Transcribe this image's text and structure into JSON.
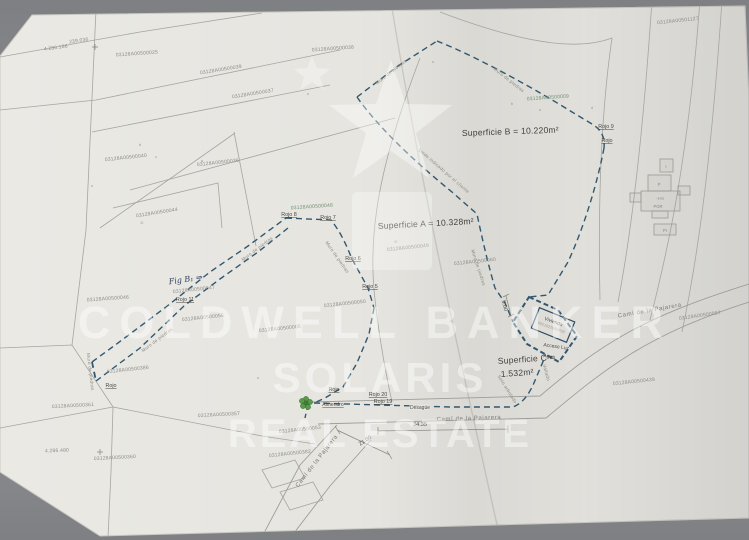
{
  "colors": {
    "boundary_blue": "#32586f",
    "tree_green": "#4f8c3f",
    "green_label": "#6f9070",
    "parcel_line_gray": "#a6a5a0",
    "paper": "#eae9e4",
    "desk": "#84868a"
  },
  "areas": {
    "a": "Superficie A = 10.328m²",
    "b": "Superficie B = 10.220m²",
    "c1": "Superficie C =",
    "c2": "1.532m²"
  },
  "parcel_refs": [
    "03128A00500025",
    "03128A00501127",
    "03128A00500038",
    "03128A00500039",
    "03128A00500037",
    "03128A00500036",
    "03128A00500040",
    "03128A00500044",
    "03128A00500046",
    "03128A00500047",
    "03128A00500055",
    "03128A00500005",
    "03128A00500050",
    "03128A00500049",
    "03128A00500060",
    "03128A00500009",
    "03128A00500048",
    "03128A00500097",
    "03128A00500439",
    "03128A00500386",
    "03128A00500361",
    "03128A00500357",
    "03128A00500360",
    "03128A00500053",
    "03128A00500382"
  ],
  "coords": [
    "239.036",
    "4.286.188",
    "4.286.480"
  ],
  "rojo_points": [
    "Rojo 9",
    "Rojo",
    "Rojo 8",
    "Rojo 7",
    "Rojo 6",
    "Rojo 5",
    "Rojo 11",
    "Rojo",
    "Rojo",
    "Rojo 20",
    "Rojo 19"
  ],
  "walls": {
    "muro": "Muro de piedras",
    "linde": "Linde indicado por el cliente",
    "vallado": "Vallado",
    "seto": "Seto arbolado"
  },
  "roads": {
    "cami": "Camí de la Pajarera"
  },
  "dims": [
    "34.35",
    "21.00",
    "5.00"
  ],
  "features": {
    "vivienda": "Vivienda",
    "vivienda_ref": "002102200DF68",
    "acceso": "Acceso Luz",
    "agua": "Agua",
    "desague": "Desagüe",
    "almendro": "Almendro",
    "annotation": "Fig B₁ ⇒"
  },
  "buildings": [
    "I",
    "P",
    "-I+II",
    "POR",
    "PI"
  ],
  "marks": [
    "b",
    "c",
    "a",
    "D",
    "b",
    "d",
    "o",
    "o",
    "o",
    "D",
    "o",
    "o"
  ],
  "watermark": {
    "brand": "COLDWELL BANKER",
    "name": "SOLARIS",
    "tagline": "REAL ESTATE"
  }
}
